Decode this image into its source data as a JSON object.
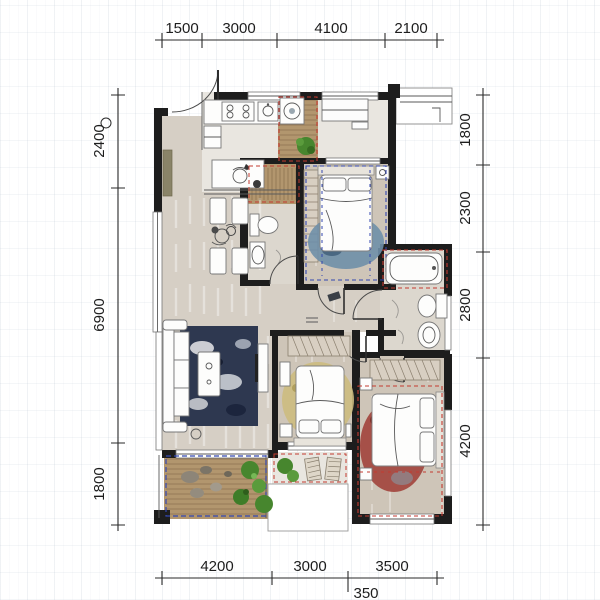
{
  "app": {
    "type": "apartment-floor-plan"
  },
  "dimensions": {
    "top": [
      "1500",
      "3000",
      "4100",
      "2100"
    ],
    "left": [
      "2400",
      "6900",
      "1800"
    ],
    "right": [
      "1800",
      "2300",
      "2800",
      "4200"
    ],
    "bottom": [
      "4200",
      "3000",
      "3500"
    ],
    "bottom_offset": "350"
  },
  "colors": {
    "wall": "#1d1d1d",
    "floor_beige": "#d6cfc5",
    "floor_light": "#e9e6e0",
    "floor_bedroom": "#cec5b8",
    "deck_wood": "#b2966e",
    "marble": "#dcd7ce",
    "dash_blue": "#3347b0",
    "dash_red": "#c43a30",
    "plant_green": "#47862e",
    "rug_navy": "#2e3850",
    "rug_blue": "#6f8fa8",
    "rug_gold": "#cdbb80",
    "rug_red": "#a04038",
    "dim_text": "#1d1d1d"
  },
  "symbols": {
    "bed": "rounded-rect-with-pillows",
    "bathtub": "rounded-rect",
    "toilet": "tank-plus-bowl-ellipse",
    "sink": "oval-basin",
    "washing-machine": "square-with-drum-circle",
    "stove": "four-burner-cooktop",
    "sofa": "l-shape-with-cushions",
    "dining-set": "four-chairs-centerpiece",
    "wardrobe": "hatched-strip",
    "plant": "green-circle-cluster",
    "door": "quarter-arc-with-leaf"
  }
}
